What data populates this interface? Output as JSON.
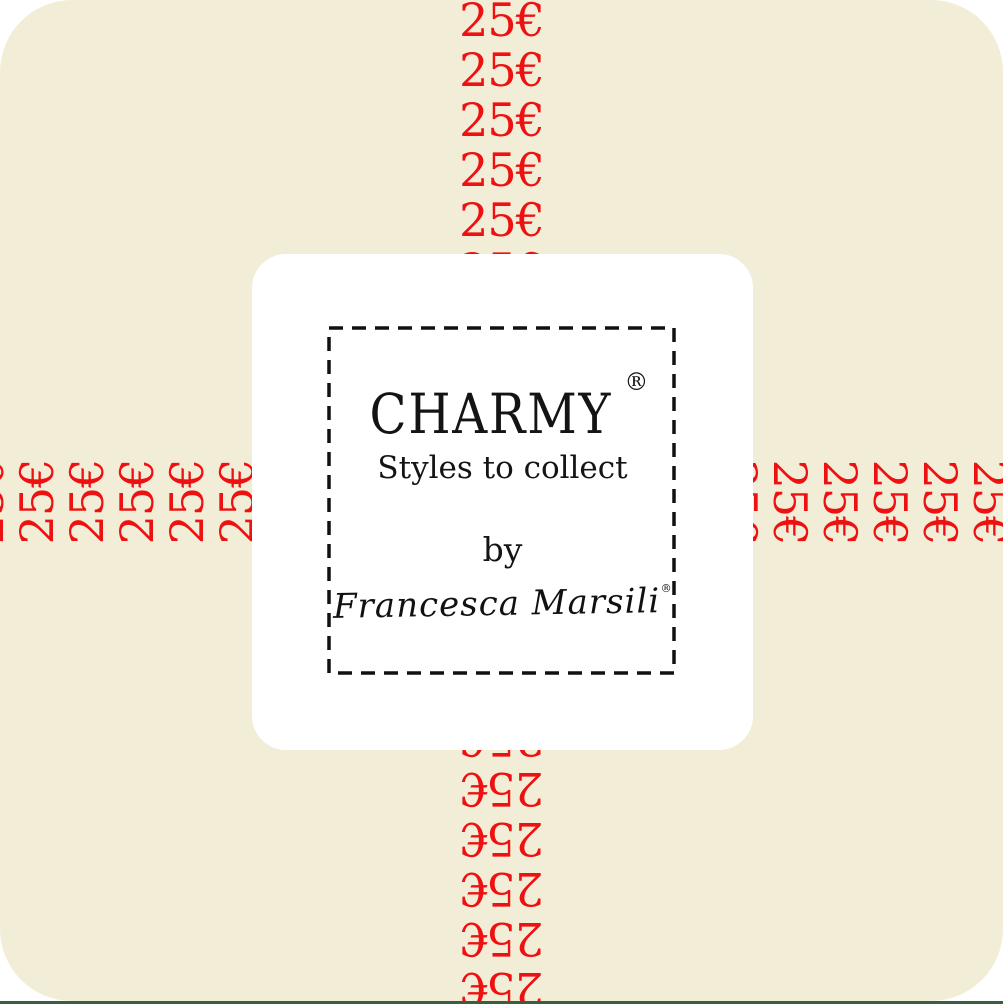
{
  "label": {
    "price": "25€",
    "brand": "CHARMY",
    "registered": "®",
    "tagline": "Styles to collect",
    "by_text": "by",
    "signature": "Francesca Marsili",
    "signature_mark": "®"
  },
  "strips": {
    "price_text": "25€",
    "top": {
      "count": 6,
      "rotation_deg": 0
    },
    "bottom": {
      "count": 6,
      "rotation_deg": 180
    },
    "left": {
      "count": 7,
      "rotation_deg": -90
    },
    "right": {
      "count": 6,
      "rotation_deg": 90
    }
  },
  "colors": {
    "page_background": "#ffffff",
    "card_cream": "#f2edd7",
    "price_red": "#ee1111",
    "text_black": "#141414",
    "panel_white": "#ffffff",
    "dashed_border": "#111111",
    "bottom_line_green": "#3a5f40"
  }
}
